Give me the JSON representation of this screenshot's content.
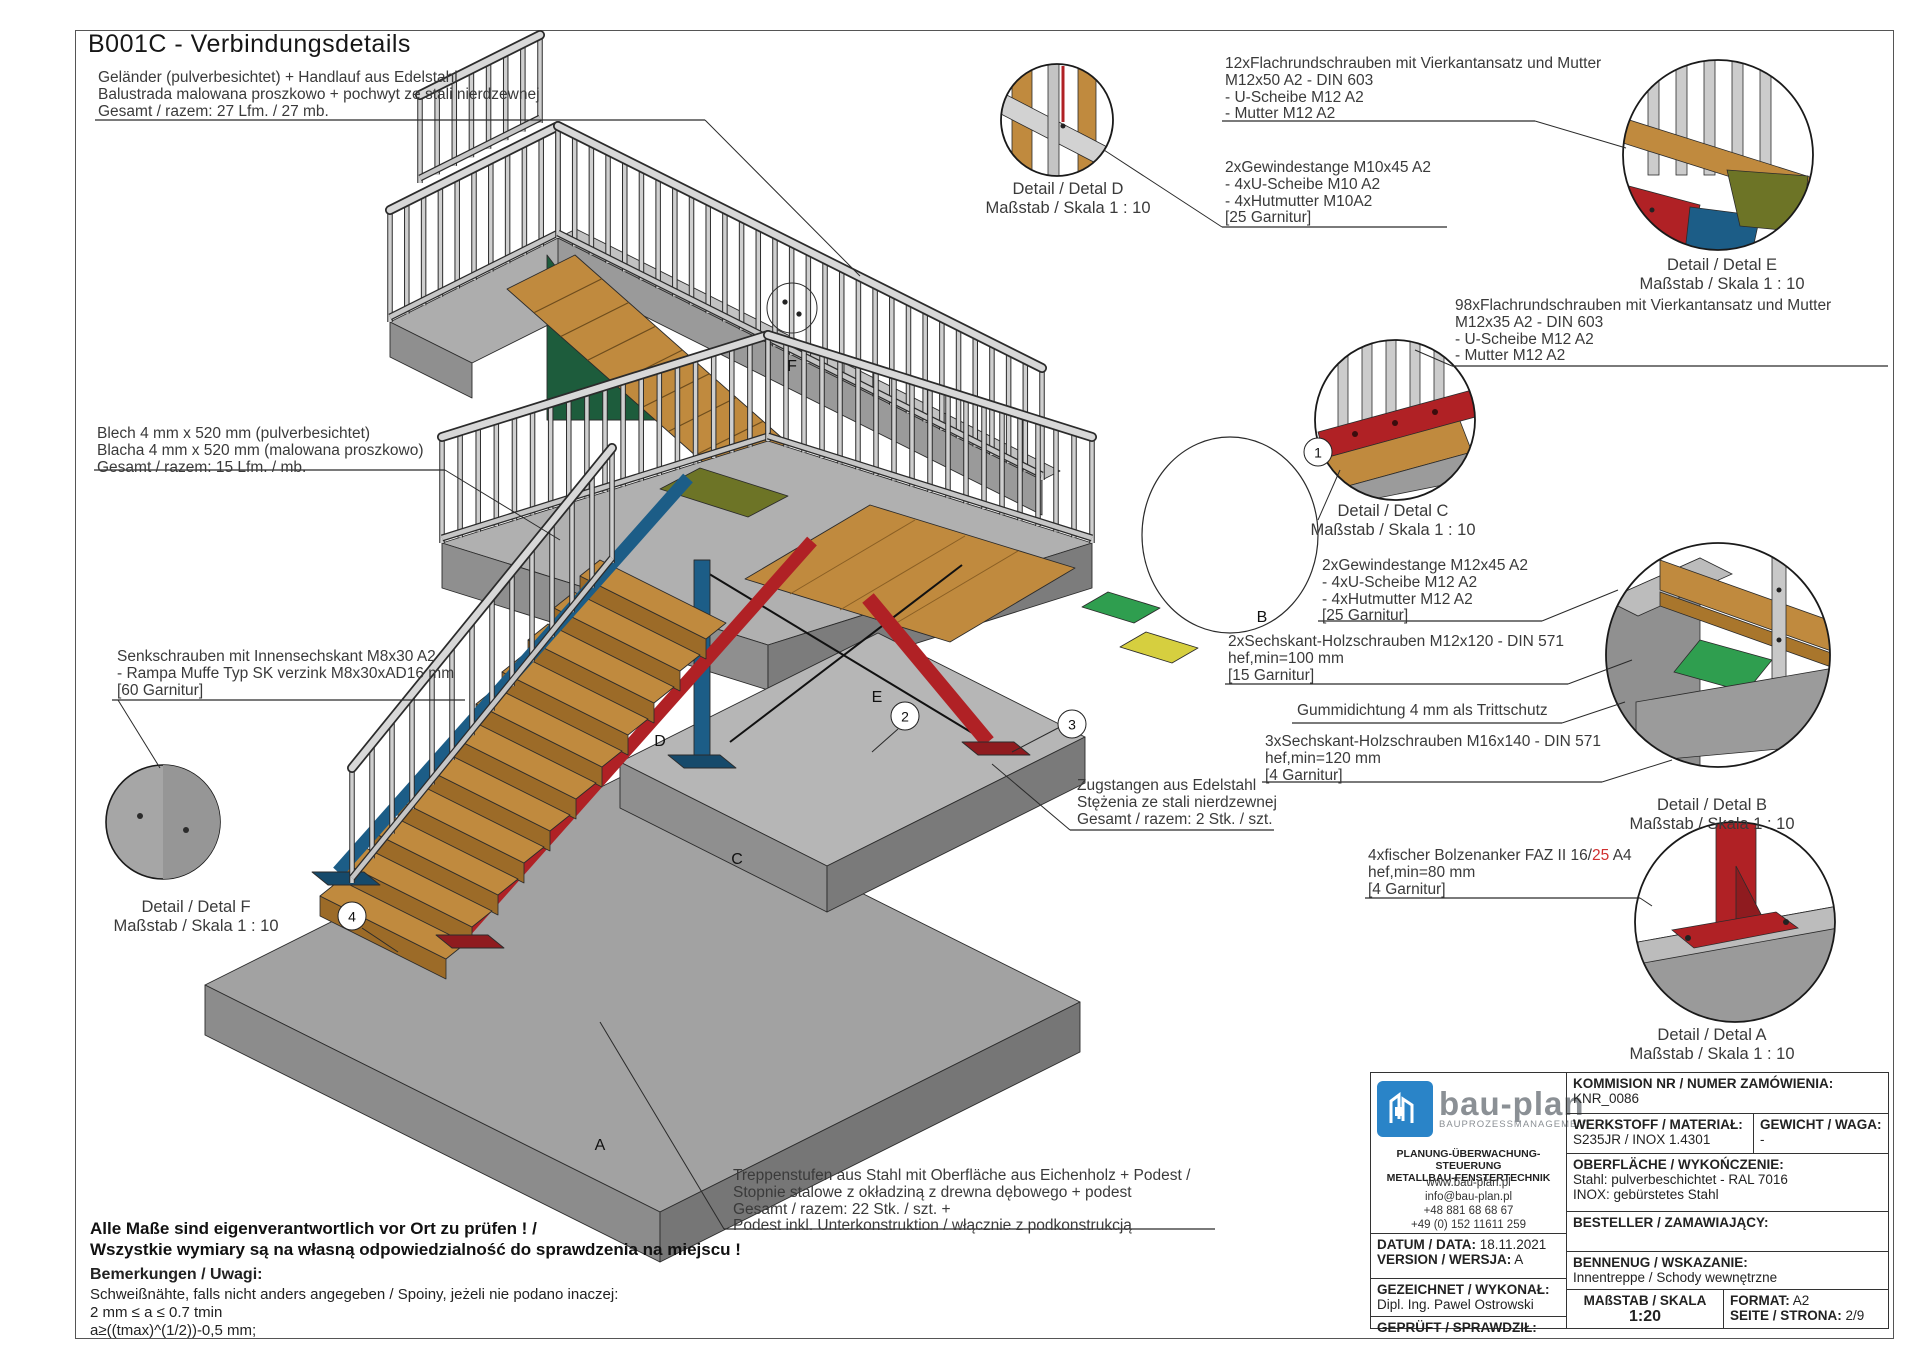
{
  "sheet": {
    "title": "B001C - Verbindungsdetails"
  },
  "colors": {
    "steel_red": "#b02125",
    "steel_blue": "#1c5d87",
    "olive": "#6d7426",
    "green": "#2f9e4f",
    "dark_green": "#1d5c3c",
    "yellow": "#d6cf3f",
    "wood": "#c08a3e",
    "concrete": "#a2a2a2",
    "steel_light": "#d6d6d6",
    "logo_blue": "#2a84c8",
    "highlight_red": "#d03030"
  },
  "annotations": {
    "gelaender": {
      "lines": [
        "Geländer (pulverbesichtet) + Handlauf aus Edelstahl",
        "Balustrada malowana proszkowo + pochwyt  ze stali nierdzewnej",
        "Gesamt / razem: 27 Lfm. / 27 mb."
      ]
    },
    "flachrund12": {
      "lines": [
        "12xFlachrundschrauben mit Vierkantansatz und Mutter",
        "M12x50 A2 - DIN 603",
        "- U-Scheibe M12 A2",
        "- Mutter M12 A2"
      ]
    },
    "gewinde10": {
      "lines": [
        "2xGewindestange M10x45 A2",
        "- 4xU-Scheibe M10 A2",
        "- 4xHutmutter M10A2",
        "[25 Garnitur]"
      ]
    },
    "flachrund98": {
      "lines": [
        "98xFlachrundschrauben mit Vierkantansatz und Mutter",
        "M12x35 A2 - DIN 603",
        "- U-Scheibe M12 A2",
        "- Mutter M12 A2"
      ]
    },
    "blech": {
      "lines": [
        "Blech 4 mm x 520 mm (pulverbesichtet)",
        "Blacha 4 mm x 520 mm (malowana proszkowo)",
        "Gesamt / razem: 15 Lfm. / mb."
      ]
    },
    "gewinde12": {
      "lines": [
        "2xGewindestange M12x45 A2",
        "- 4xU-Scheibe M12 A2",
        "- 4xHutmutter M12 A2",
        "[25 Garnitur]"
      ]
    },
    "sechskant2": {
      "lines": [
        "2xSechskant-Holzschrauben M12x120 - DIN 571",
        "hef,min=100 mm",
        "[15 Garnitur]"
      ]
    },
    "gummi": {
      "text": "Gummidichtung 4 mm als Trittschutz"
    },
    "sechskant3": {
      "lines": [
        "3xSechskant-Holzschrauben M16x140 - DIN 571",
        "hef,min=120 mm",
        "[4 Garnitur]"
      ]
    },
    "senkschrauben": {
      "lines": [
        "Senkschrauben mit Innensechskant M8x30 A2",
        "- Rampa Muffe Typ SK verzink M8x30xAD16 mm",
        "[60 Garnitur]"
      ]
    },
    "zugstangen": {
      "lines": [
        "Zugstangen aus Edelstahl",
        "Stężenia ze stali nierdzewnej",
        "Gesamt / razem: 2 Stk. / szt."
      ]
    },
    "fischer": {
      "line1_pre": "4xfischer Bolzenanker FAZ II 16/",
      "line1_red": "25",
      "line1_post": " A4",
      "line2": "hef,min=80 mm",
      "line3": "[4 Garnitur]"
    },
    "treppenstufen": {
      "lines": [
        "Treppenstufen aus Stahl mit Oberfläche aus Eichenholz + Podest /",
        "Stopnie stalowe z okładziną z drewna dębowego + podest",
        "Gesamt / razem: 22 Stk. / szt. +",
        "Podest inkl. Unterkonstruktion / włącznie z podkonstrukcją"
      ]
    },
    "allemasse": {
      "lines": [
        "Alle Maße sind eigenverantwortlich vor Ort zu prüfen ! /",
        "Wszystkie wymiary są na własną odpowiedzialność do sprawdzenia na miejscu !"
      ]
    },
    "bemerkungen": {
      "heading": "Bemerkungen / Uwagi:",
      "lines": [
        "Schweißnähte, falls nicht anders angegeben / Spoiny, jeżeli nie podano inaczej:",
        "2  mm ≤ a ≤ 0.7 tmin",
        "a≥((tmax)^(1/2))-0,5 mm;"
      ]
    }
  },
  "details": {
    "a": {
      "name": "Detail / Detal A",
      "scale": "Maßstab / Skala 1 : 10"
    },
    "b": {
      "name": "Detail / Detal B",
      "scale": "Maßstab / Skala 1 : 10"
    },
    "c": {
      "name": "Detail / Detal C",
      "scale": "Maßstab / Skala 1 : 10"
    },
    "d": {
      "name": "Detail / Detal D",
      "scale": "Maßstab / Skala 1 : 10"
    },
    "e": {
      "name": "Detail / Detal E",
      "scale": "Maßstab / Skala 1 : 10"
    },
    "f": {
      "name": "Detail / Detal F",
      "scale": "Maßstab / Skala 1 : 10"
    }
  },
  "refs": {
    "numbers": [
      "1",
      "2",
      "3",
      "4"
    ],
    "letters": [
      "A",
      "B",
      "C",
      "D",
      "E",
      "F"
    ]
  },
  "title_block": {
    "logo": {
      "name": "bau-plan",
      "subtitle": "BAUPROZESSMANAGEMENT",
      "tagline1": "PLANUNG-ÜBERWACHUNG-STEUERUNG",
      "tagline2": "METALLBAU-FENSTERTECHNIK",
      "web": "www.bau-plan.pl",
      "email": "info@bau-plan.pl",
      "phone1": "+48 881 68  68 67",
      "phone2": "+49 (0) 152 11611 259"
    },
    "fields": {
      "kommision_label": "KOMMISION NR / NUMER ZAMÓWIENIA:",
      "kommision_value": "KNR_0086",
      "werkstoff_label": "WERKSTOFF / MATERIAŁ:",
      "werkstoff_value": "S235JR / INOX 1.4301",
      "gewicht_label": "GEWICHT / WAGA:",
      "gewicht_value": "-",
      "oberflaeche_label": "OBERFLÄCHE / WYKOŃCZENIE:",
      "oberflaeche_value1": "Stahl: pulverbeschichtet - RAL 7016",
      "oberflaeche_value2": "INOX: gebürstetes Stahl",
      "datum_label": "DATUM / DATA:",
      "datum_value": "18.11.2021",
      "version_label": "VERSION / WERSJA:",
      "version_value": "A",
      "besteller_label": "BESTELLER / ZAMAWIAJĄCY:",
      "gezeichnet_label": "GEZEICHNET / WYKONAŁ:",
      "gezeichnet_value": "Dipl. Ing. Pawel Ostrowski",
      "bennenug_label": "BENNENUG / WSKAZANIE:",
      "bennenug_value": "Innentreppe / Schody wewnętrzne",
      "geprueft_label": "GEPRÜFT / SPRAWDZIŁ:",
      "massstab_label": "MAßSTAB / SKALA",
      "massstab_value": "1:20",
      "format_label": "FORMAT:",
      "format_value": "A2",
      "seite_label": "SEITE / STRONA:",
      "seite_value": "2/9"
    }
  }
}
